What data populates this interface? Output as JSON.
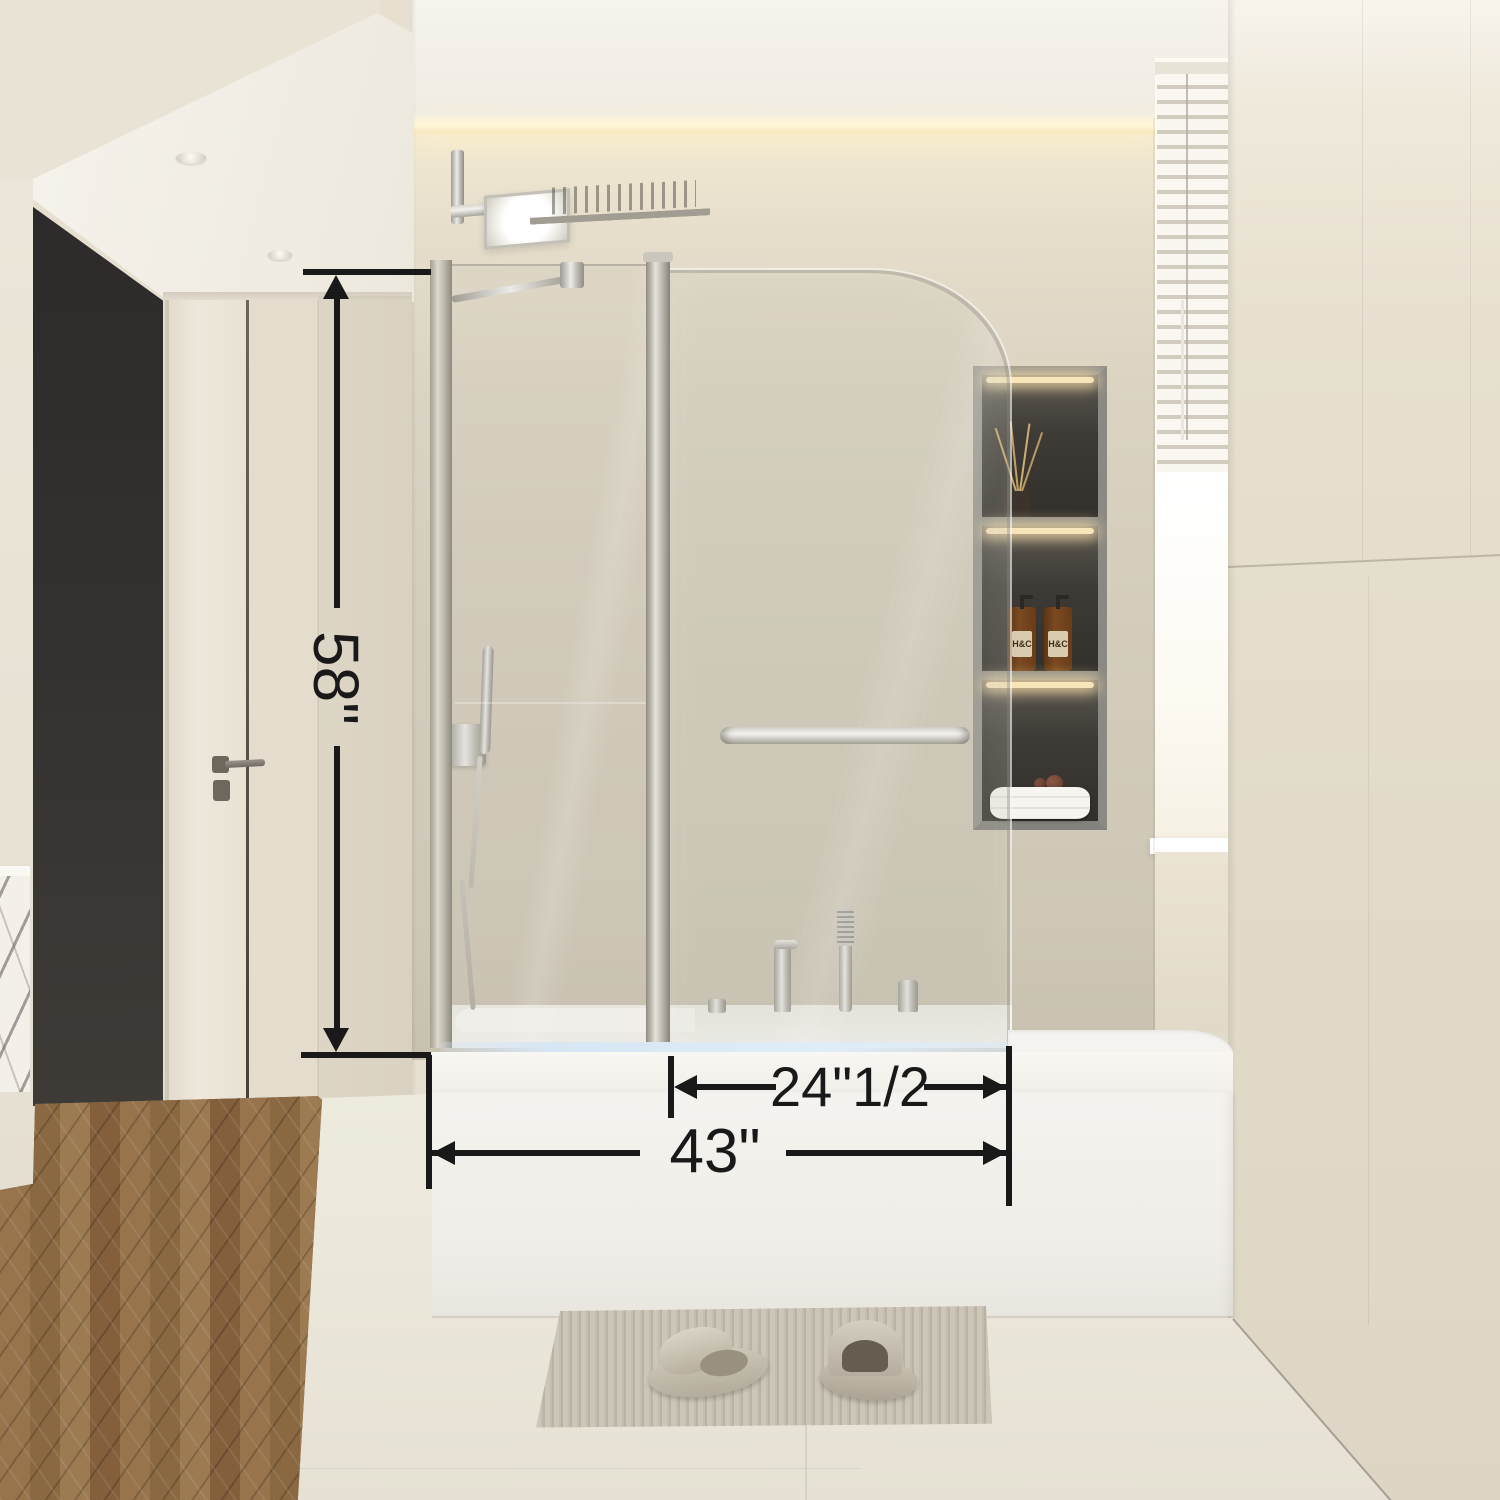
{
  "annotations": {
    "height": "58\"",
    "panel_width": "24\"1/2",
    "total_width": "43\""
  },
  "niche": {
    "bottles": [
      {
        "label": "H&C"
      },
      {
        "label": "H&C"
      }
    ]
  },
  "colors": {
    "annotation": "#191919",
    "wall": "#d5cebd",
    "ceiling": "#f4f1ea",
    "dark-wall": "#2d2b2a",
    "door": "#e9e3d5",
    "wood": "#8d6c48",
    "tub": "#f4f3ef",
    "chrome": "#c9c6bf",
    "led": "#dfedf9",
    "amber": "#7a4a22",
    "floor": "#ebe7da",
    "mat": "#c4bdae"
  }
}
